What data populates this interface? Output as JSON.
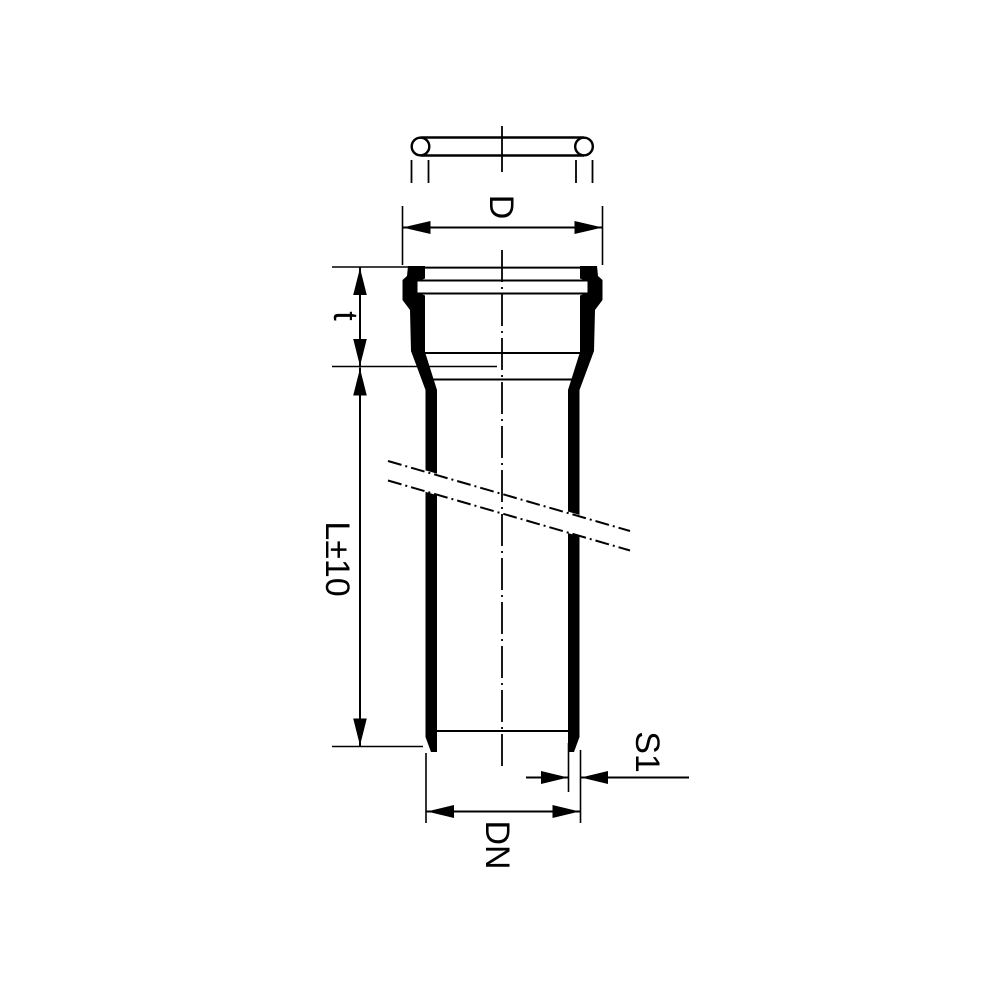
{
  "drawing": {
    "type": "technical-drawing-pipe-with-socket",
    "colors": {
      "line": "#000000",
      "background": "#ffffff"
    },
    "labels": {
      "socket_outer_diameter": "D",
      "socket_depth": "t",
      "pipe_length": "L±10",
      "wall_thickness": "S1",
      "nominal_diameter": "DN"
    }
  }
}
